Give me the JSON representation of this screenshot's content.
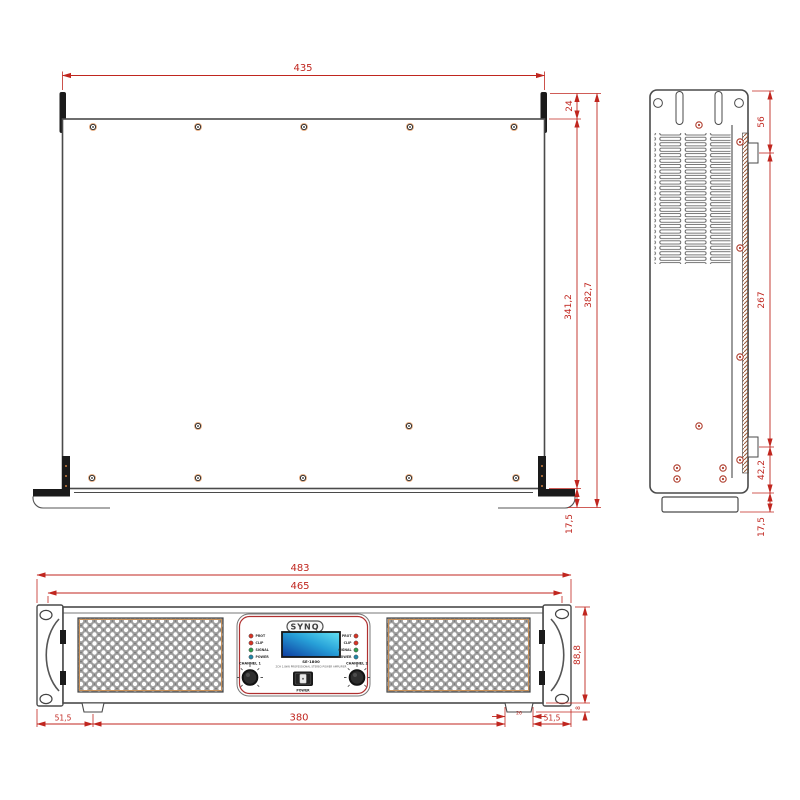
{
  "meta": {
    "background": "#ffffff",
    "dimension_color": "#c0261f",
    "outline_color": "#4a4a4a"
  },
  "top_view": {
    "width": "435",
    "rear_flange_depth": "24",
    "body_depth": "341,2",
    "total_depth": "382,7",
    "handle_offset": "17,5"
  },
  "side_view": {
    "top_section": "56",
    "rail_span": "267",
    "bottom_section": "42,2",
    "foot_section": "17,5"
  },
  "front_view": {
    "total_width": "483",
    "inner_width": "465",
    "panel_height": "88,8",
    "foot_height": "8",
    "left_foot_offset": "51,5",
    "feet_span": "380",
    "foot_width": "26",
    "right_foot_offset": "51,5"
  },
  "front_panel": {
    "brand": "SYNQ",
    "model": "SE-1800",
    "subtitle": "2CH 1.8kW PROFESSIONAL STEREO POWER AMPLIFIER",
    "channel_1_label": "CHANNEL 1",
    "channel_2_label": "CHANNEL 2",
    "power_label": "POWER",
    "led_labels": [
      "PROT",
      "CLIP",
      "SIGNAL",
      "POWER"
    ],
    "led_colors": [
      "#d93425",
      "#d93425",
      "#2f9e4f",
      "#2187a8"
    ],
    "display_gradient": [
      "#0d3a9e",
      "#27a0d8",
      "#62e2f4"
    ]
  }
}
